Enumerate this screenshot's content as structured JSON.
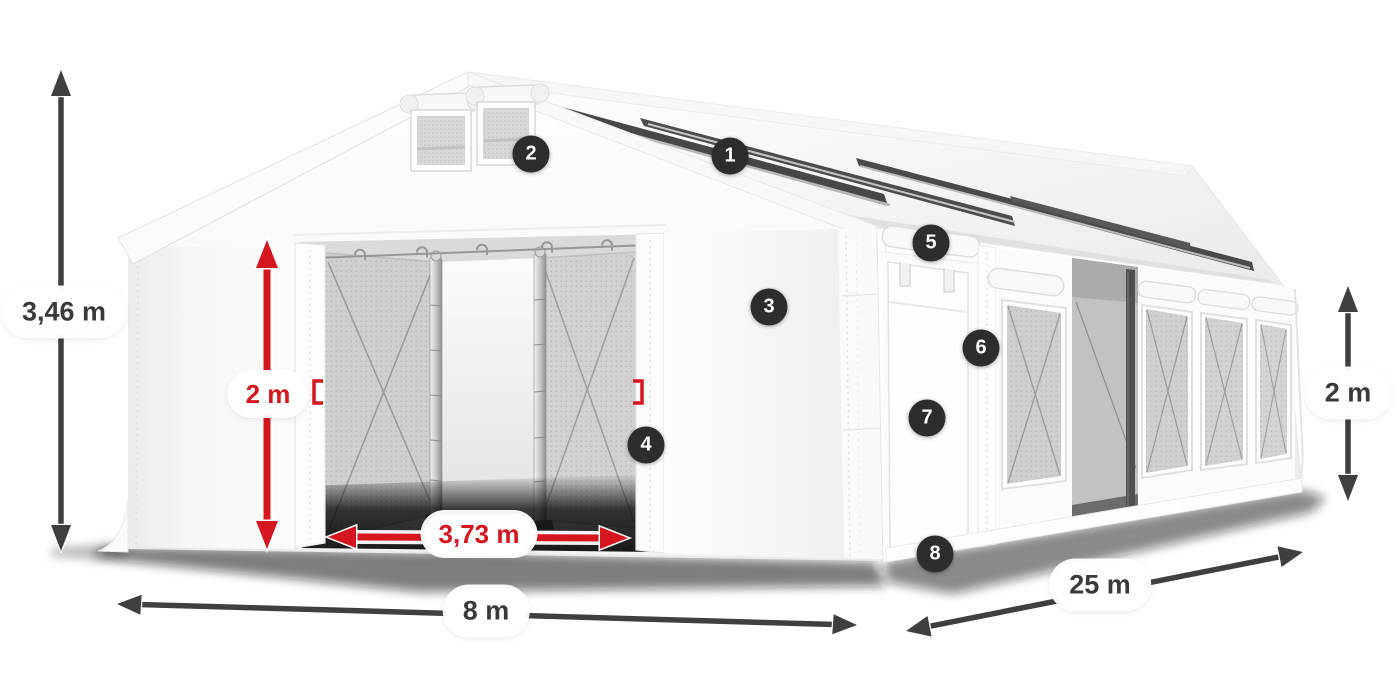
{
  "diagram": {
    "dimensions": {
      "total_height": "3,46 m",
      "door_height": "2 m",
      "door_width": "3,73 m",
      "tent_width": "8 m",
      "tent_length": "25 m",
      "side_height": "2 m"
    },
    "callouts": [
      {
        "number": "1"
      },
      {
        "number": "2"
      },
      {
        "number": "3"
      },
      {
        "number": "4"
      },
      {
        "number": "5"
      },
      {
        "number": "6"
      },
      {
        "number": "7"
      },
      {
        "number": "8"
      }
    ],
    "colors": {
      "background": "#ffffff",
      "dimension_dark": "#3f3f3f",
      "dimension_red": "#d6161f",
      "badge_bg": "#2d2d2d",
      "badge_text": "#ffffff",
      "pill_bg": "#ffffff",
      "pill_text": "#3a3a3a"
    }
  }
}
